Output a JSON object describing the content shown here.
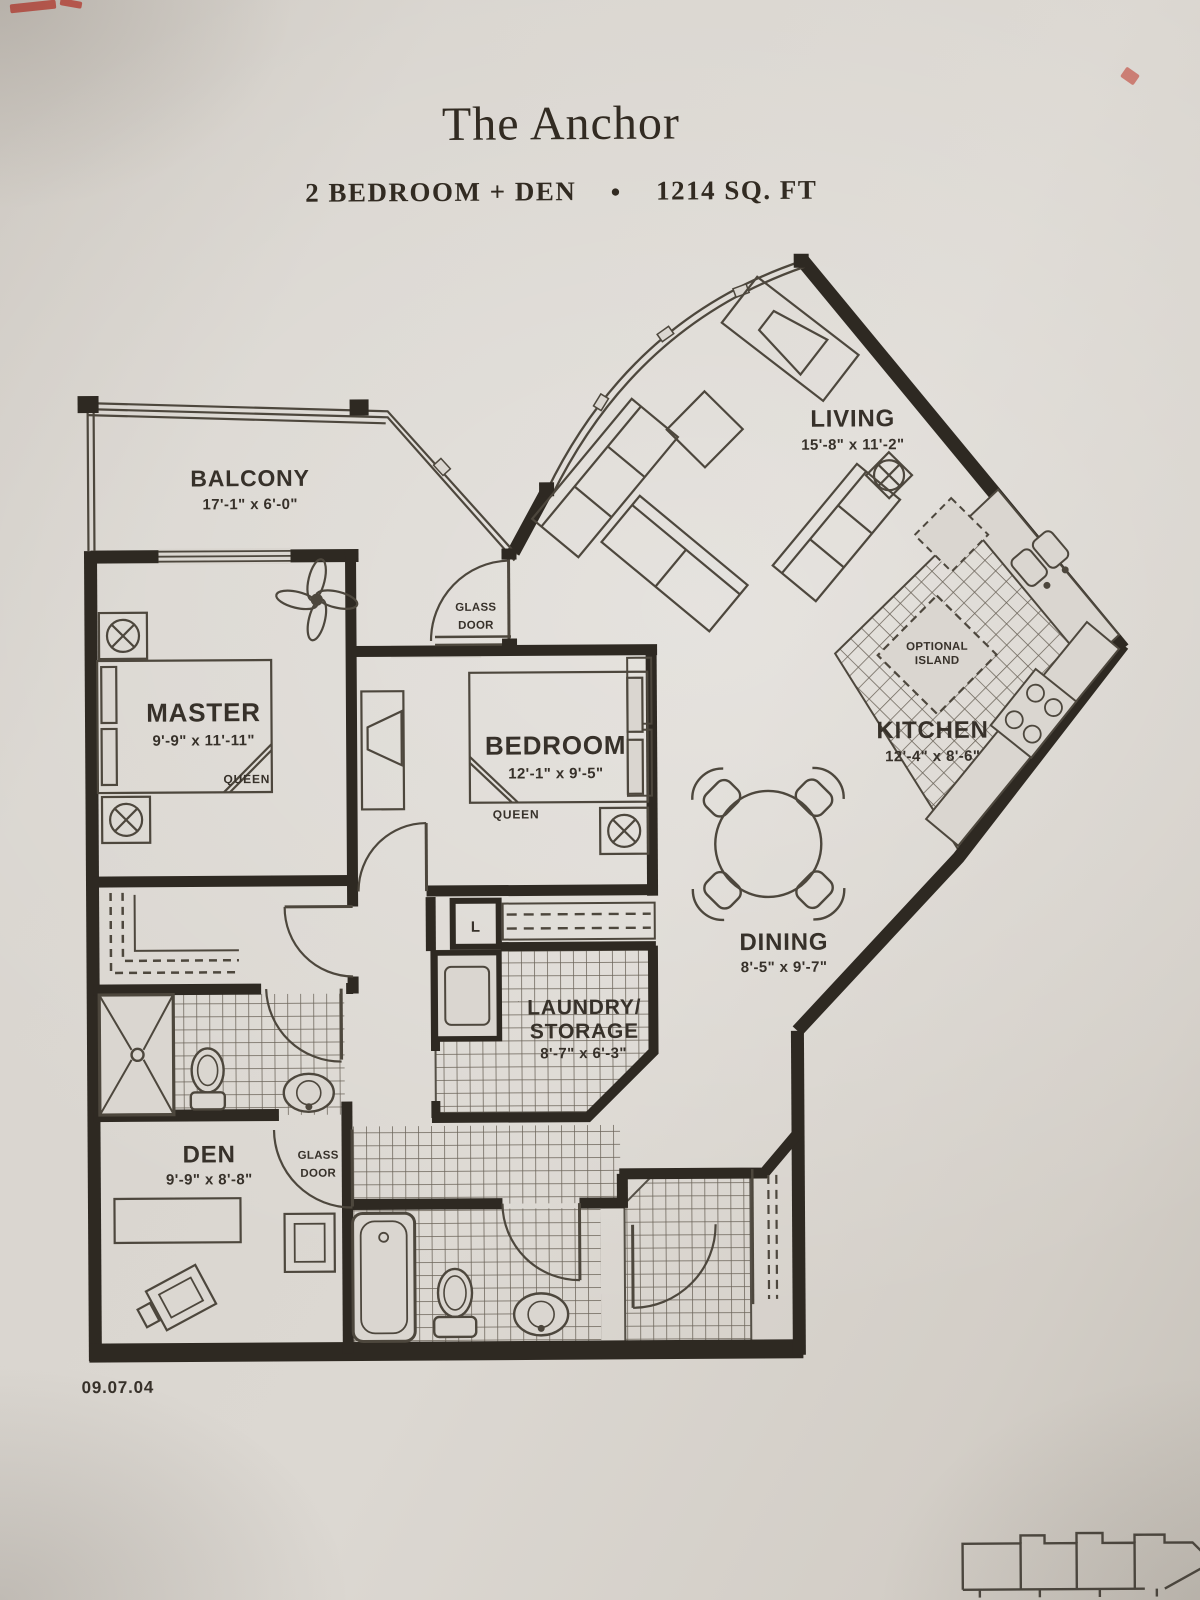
{
  "header": {
    "title": "The Anchor",
    "subtitle_left": "2 BEDROOM + DEN",
    "bullet": "●",
    "subtitle_right": "1214 SQ. FT"
  },
  "rooms": {
    "balcony": {
      "name": "BALCONY",
      "dims": "17'-1\" x 6'-0\""
    },
    "living": {
      "name": "LIVING",
      "dims": "15'-8\" x 11'-2\""
    },
    "master": {
      "name": "MASTER",
      "dims": "9'-9\" x 11'-11\"",
      "bed": "QUEEN"
    },
    "bedroom": {
      "name": "BEDROOM",
      "dims": "12'-1\" x 9'-5\"",
      "bed": "QUEEN"
    },
    "kitchen": {
      "name": "KITCHEN",
      "dims": "12'-4\" x 8'-6\"",
      "island_line1": "OPTIONAL",
      "island_line2": "ISLAND"
    },
    "dining": {
      "name": "DINING",
      "dims": "8'-5\" x 9'-7\""
    },
    "laundry": {
      "name_line1": "LAUNDRY/",
      "name_line2": "STORAGE",
      "dims": "8'-7\" x 6'-3\""
    },
    "den": {
      "name": "DEN",
      "dims": "9'-9\" x 8'-8\""
    }
  },
  "labels": {
    "glass_door_line1": "GLASS",
    "glass_door_line2": "DOOR",
    "linen_closet": "L"
  },
  "footer": {
    "date_stamp": "09.07.04"
  },
  "colors": {
    "paper": "#d9d5cf",
    "ink": "#37312a",
    "wall": "#2e2922",
    "tile_line": "#6b6459",
    "pen_mark_red": "#bf4136"
  }
}
